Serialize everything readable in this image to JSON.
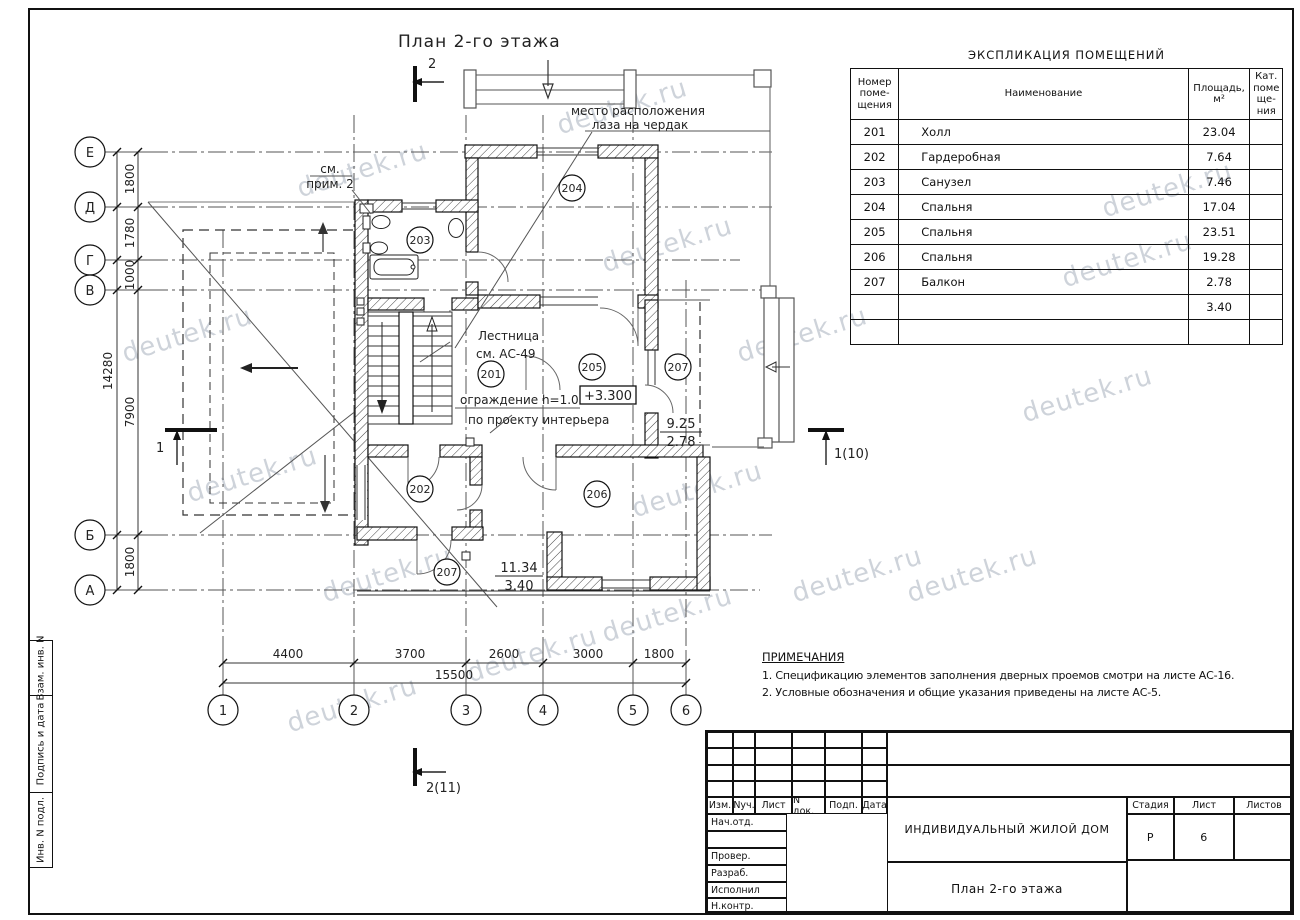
{
  "sheet": {
    "title": "План 2-го этажа"
  },
  "watermark": {
    "text": "deutek.ru"
  },
  "axes": {
    "rows": [
      "Е",
      "Д",
      "Г",
      "В",
      "Б",
      "А"
    ],
    "cols": [
      "1",
      "2",
      "3",
      "4",
      "5",
      "6"
    ]
  },
  "dims": {
    "left": [
      "1800",
      "1780",
      "1000",
      "7900",
      "1800"
    ],
    "left_total": "14280",
    "bottom": [
      "4400",
      "3700",
      "2600",
      "3000",
      "1800"
    ],
    "bottom_total": "15500"
  },
  "plan": {
    "rooms": {
      "r201": "201",
      "r202": "202",
      "r203": "203",
      "r204": "204",
      "r205": "205",
      "r206": "206",
      "r207a": "207",
      "r207b": "207"
    },
    "labels": {
      "attic1": "место расположения",
      "attic2": "лаза на чердак",
      "note_ref1": "см.",
      "note_ref2": "прим. 2",
      "stairs1": "Лестница",
      "stairs2": "см. АС-49",
      "railing1": "ограждение h=1.0м",
      "railing2": "по проекту интерьера",
      "elevation": "+3.300",
      "balcony_right_num": "9.25",
      "balcony_right_den": "2.78",
      "balcony_bottom_num": "11.34",
      "balcony_bottom_den": "3.40"
    },
    "sections": {
      "top": "2",
      "bottom": "2(11)",
      "left": "1",
      "right": "1(10)"
    }
  },
  "explication": {
    "title": "ЭКСПЛИКАЦИЯ ПОМЕЩЕНИЙ",
    "headers": {
      "num": "Номер\nпоме-\nщения",
      "name": "Наименование",
      "area": "Площадь,\nм²",
      "cat": "Кат.\nпоме\nще-\nния"
    },
    "rows": [
      {
        "num": "201",
        "name": "Холл",
        "area": "23.04",
        "cat": ""
      },
      {
        "num": "202",
        "name": "Гардеробная",
        "area": "7.64",
        "cat": ""
      },
      {
        "num": "203",
        "name": "Санузел",
        "area": "7.46",
        "cat": ""
      },
      {
        "num": "204",
        "name": "Спальня",
        "area": "17.04",
        "cat": ""
      },
      {
        "num": "205",
        "name": "Спальня",
        "area": "23.51",
        "cat": ""
      },
      {
        "num": "206",
        "name": "Спальня",
        "area": "19.28",
        "cat": ""
      },
      {
        "num": "207",
        "name": "Балкон",
        "area": "2.78",
        "cat": ""
      },
      {
        "num": "",
        "name": "",
        "area": "3.40",
        "cat": ""
      },
      {
        "num": "",
        "name": "",
        "area": "",
        "cat": ""
      }
    ]
  },
  "notes": {
    "heading": "ПРИМЕЧАНИЯ",
    "items": [
      "1.  Спецификацию элементов заполнения дверных проемов смотри на листе АС-16.",
      "2.  Условные обозначения и общие указания приведены на листе АС-5."
    ]
  },
  "titleblock": {
    "rev_headers": [
      "Изм.",
      "Nуч.",
      "Лист",
      "N док.",
      "Подп.",
      "Дата"
    ],
    "left_rows": [
      "Нач.отд.",
      "",
      "Провер.",
      "Разраб.",
      "Исполнил",
      "Н.контр."
    ],
    "project": "ИНДИВИДУАЛЬНЫЙ ЖИЛОЙ ДОМ",
    "drawing": "План 2-го этажа",
    "stage_headers": [
      "Стадия",
      "Лист",
      "Листов"
    ],
    "stage": "Р",
    "sheet_no": "6",
    "sheets_total": ""
  },
  "stamp_column": [
    "Взам. инв. N",
    "Подпись и дата",
    "Инв. N подл."
  ]
}
